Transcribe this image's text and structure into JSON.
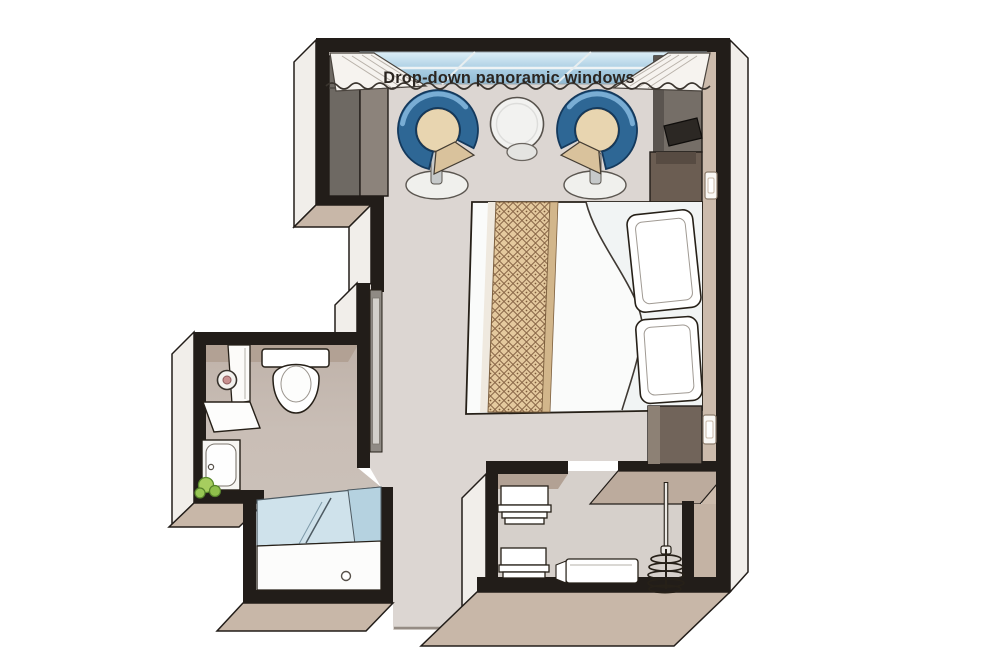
{
  "window_label": {
    "text": "Drop-down panoramic windows"
  },
  "palette": {
    "wall": "#221d19",
    "floor_main": "#dcd6d2",
    "floor_bathroom": "#c9beb6",
    "floor_closet": "#d6d0cb",
    "wall_face_light": "#f1eeea",
    "wall_face_tan": "#c8b7a8",
    "inner_band_tan": "#b2a194",
    "window_glass_light": "#dceef7",
    "window_glass_deep": "#8fb9d2",
    "chair_blue": "#2e6795",
    "chair_rim_navy": "#14395c",
    "chair_highlight": "#79add4",
    "chair_seat": "#e8d5b0",
    "runner_tan": "#e4c99e",
    "runner_lattice": "#8a6848",
    "furniture_dark": "#756e67",
    "nightstand_brown": "#6b5d52",
    "tv_black": "#2c2824",
    "mirror_grey": "#8f8a84",
    "plant_green": "#a6cd5f",
    "outline": "#262018"
  },
  "rooms": {
    "main_cabin": {
      "furniture": [
        "wardrobe",
        "tv-cabinet",
        "tv",
        "armchair-left",
        "armchair-right",
        "round-table",
        "double-bed",
        "bed-runner",
        "pillow-top",
        "pillow-bottom",
        "nightstand-top",
        "nightstand-bottom",
        "light-switch-top",
        "light-switch-bottom",
        "wall-mirror"
      ]
    },
    "bathroom": {
      "furniture": [
        "toilet",
        "bathroom-door",
        "magnifying-mirror",
        "vanity-counter",
        "vanity-cabinet",
        "plant",
        "shower-glass",
        "shower-tray",
        "shower-drain"
      ]
    },
    "closet": {
      "furniture": [
        "shelf-stack-top",
        "shelf-stack-bottom",
        "safe-drawer",
        "hanging-rail",
        "hangers"
      ]
    }
  }
}
